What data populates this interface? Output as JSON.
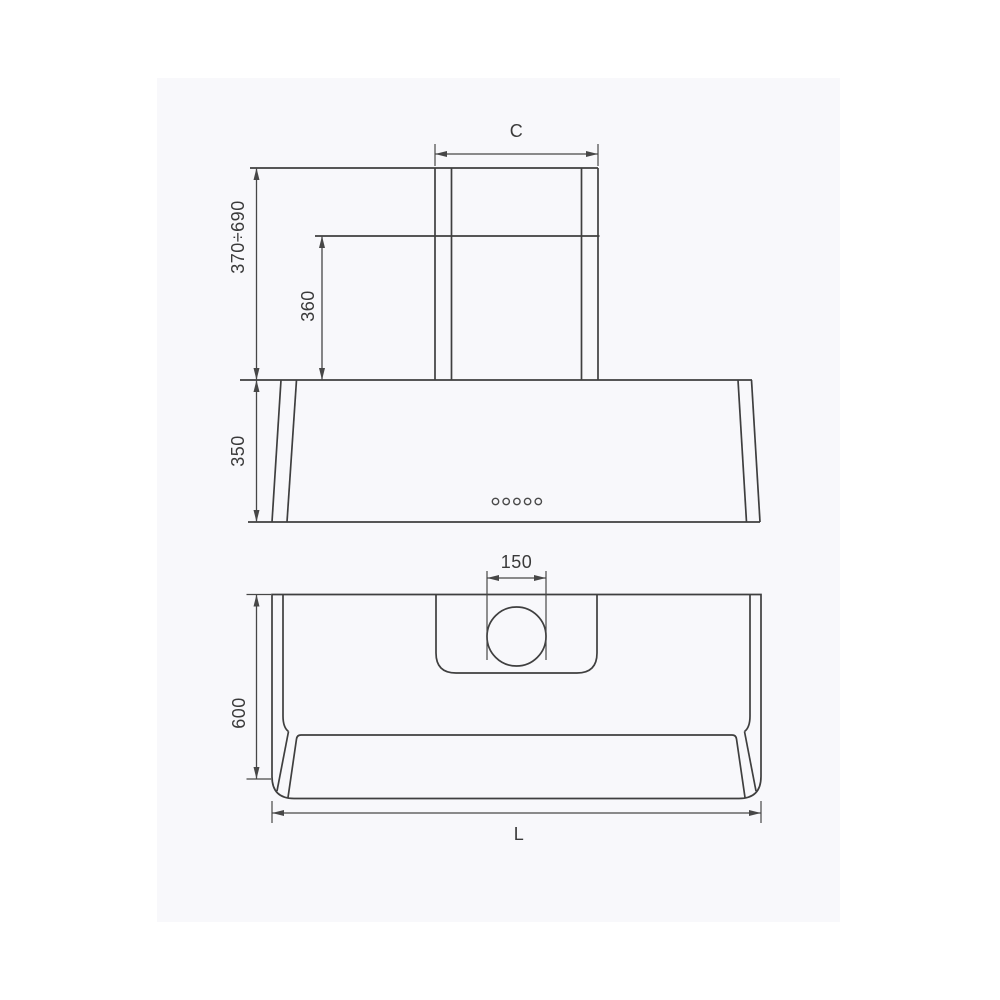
{
  "style": {
    "page_background": "#ffffff",
    "panel_background": "#f8f8fb",
    "line_color": "#3f3f3f",
    "text_color": "#3a3a3a"
  },
  "drawing_type": "range-hood installation dimension drawing",
  "front_view": {
    "view": "front elevation with telescopic chimney",
    "dims": [
      {
        "id": "chimney-width",
        "label": "C",
        "orientation": "horizontal"
      },
      {
        "id": "chimney-height-range",
        "label": "370÷690",
        "orientation": "vertical"
      },
      {
        "id": "chimney-lower-height",
        "label": "360",
        "orientation": "vertical"
      },
      {
        "id": "body-height",
        "label": "350",
        "orientation": "vertical"
      }
    ],
    "control_buttons": 5
  },
  "plan_view": {
    "view": "top plan with duct outlet",
    "dims": [
      {
        "id": "duct-diameter",
        "label": "150",
        "orientation": "horizontal"
      },
      {
        "id": "body-depth",
        "label": "600",
        "orientation": "vertical"
      },
      {
        "id": "body-width",
        "label": "L",
        "orientation": "horizontal"
      }
    ]
  }
}
